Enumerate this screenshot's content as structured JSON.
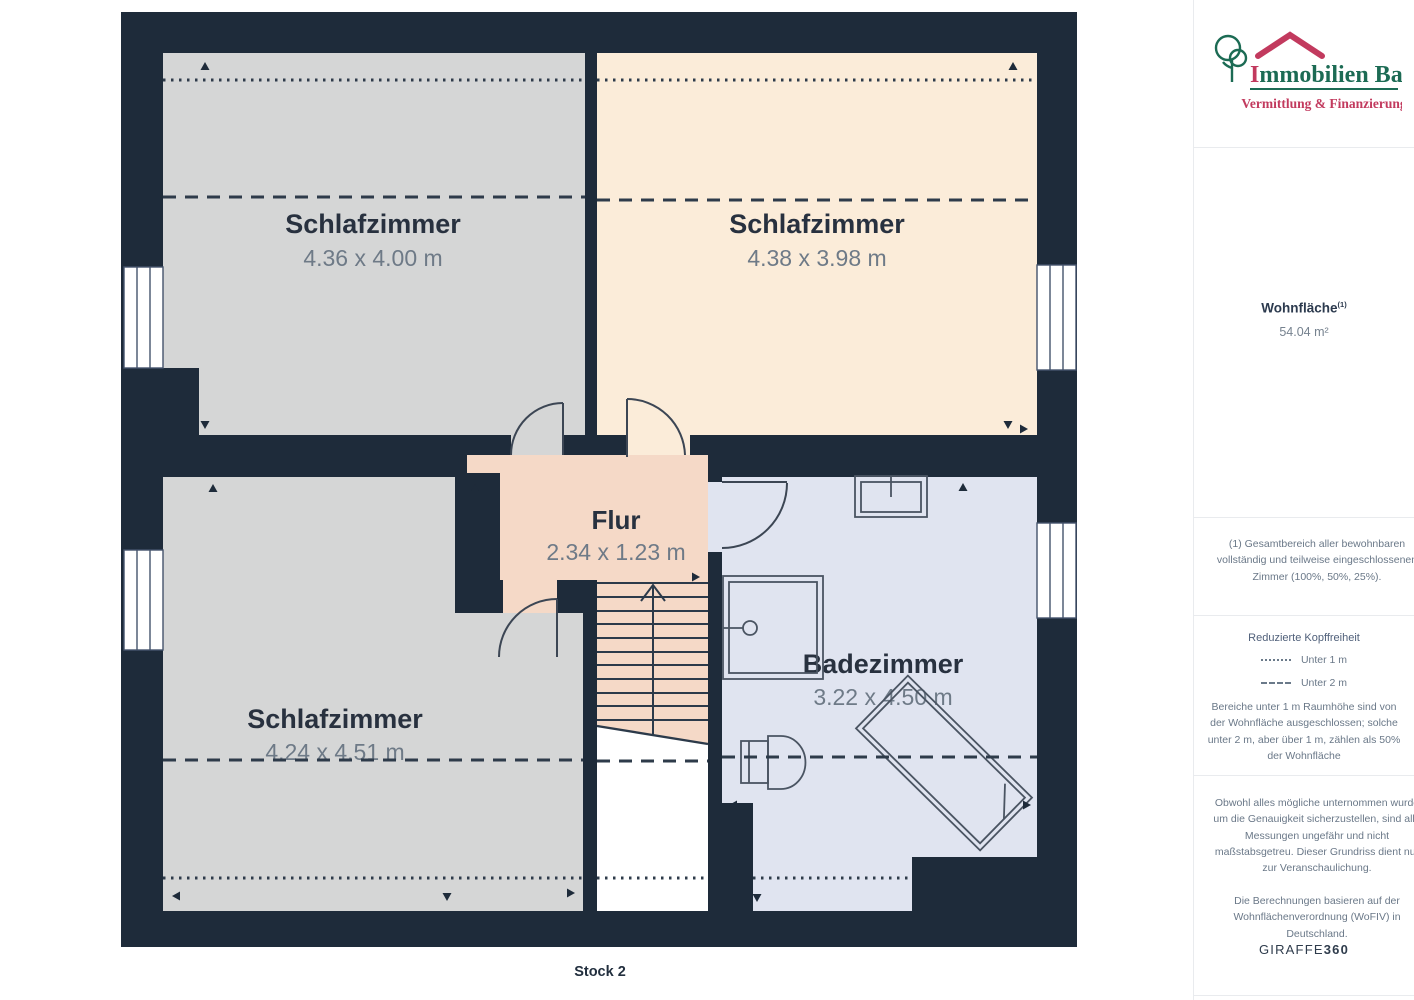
{
  "plan": {
    "floor_label": "Stock 2",
    "rooms": [
      {
        "name": "Schlafzimmer",
        "dims": "4.36 x 4.00 m"
      },
      {
        "name": "Schlafzimmer",
        "dims": "4.38 x 3.98 m"
      },
      {
        "name": "Schlafzimmer",
        "dims": "4.24 x 4.51 m"
      },
      {
        "name": "Flur",
        "dims": "2.34 x 1.23 m"
      },
      {
        "name": "Badezimmer",
        "dims": "3.22 x 4.50 m"
      }
    ],
    "colors": {
      "wall": "#1e2b3a",
      "room_gray": "#d5d6d6",
      "room_cream": "#fbecd9",
      "flur_salmon": "#f5d9c7",
      "bath_blue": "#e0e4f0"
    }
  },
  "sidebar": {
    "logo": {
      "initial": "I",
      "rest": "mmobilien Bart",
      "subtitle": "Vermittlung & Finanzierung",
      "green": "#1c6b54",
      "red": "#c23a5e"
    },
    "area": {
      "label": "Wohnfläche",
      "superscript": "(1)",
      "value": "54.04 m²"
    },
    "footnote": "(1) Gesamtbereich aller bewohnbaren vollständig und teilweise eingeschlossenen Zimmer (100%, 50%, 25%).",
    "legend": {
      "title": "Reduzierte Kopffreiheit",
      "items": [
        {
          "style": "dotted",
          "label": "Unter 1 m"
        },
        {
          "style": "dashed",
          "label": "Unter 2 m"
        }
      ],
      "note": "Bereiche unter 1 m Raumhöhe sind von der Wohnfläche ausgeschlossen; solche unter 2 m, aber über 1 m, zählen als 50% der Wohnfläche"
    },
    "disclaimer1": "Obwohl alles mögliche unternommen wurde um die Genauigkeit sicherzustellen, sind alle Messungen ungefähr und nicht maßstabsgetreu. Dieser Grundriss dient nur zur Veranschaulichung.",
    "disclaimer2": "Die Berechnungen basieren auf der Wohnflächenverordnung (WoFIV) in Deutschland.",
    "brand": {
      "part1": "GIRAFFE",
      "part2": "360"
    }
  }
}
